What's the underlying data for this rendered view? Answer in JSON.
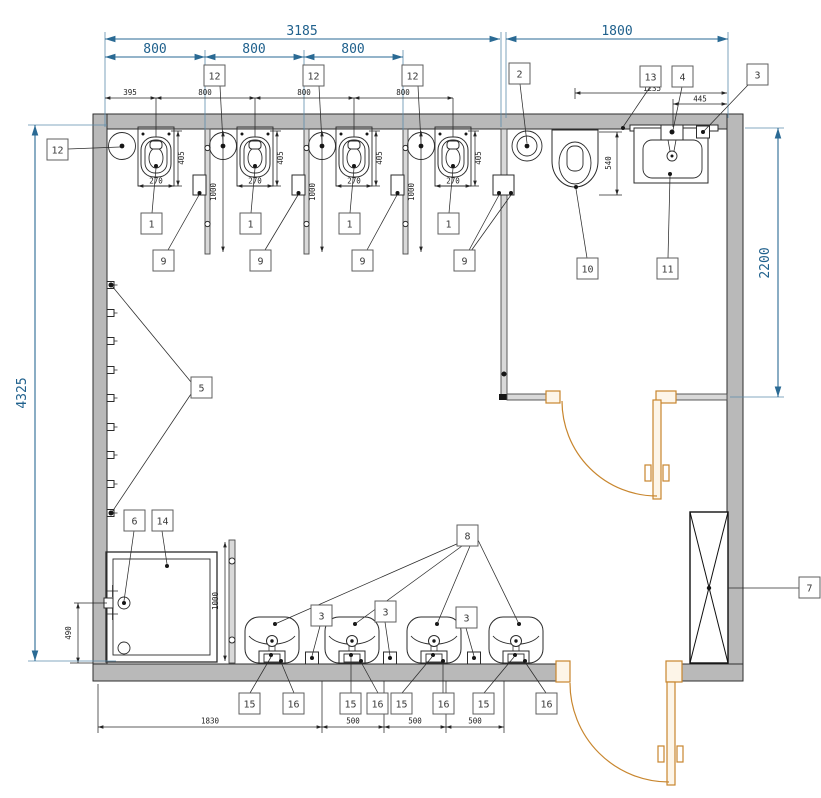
{
  "dims": {
    "overall_width_left": "3185",
    "overall_width_right": "1800",
    "urinal_bay": "800",
    "first_urinal_offset": "395",
    "overall_depth": "4325",
    "wc_room_depth": "2200",
    "urinal_width": "270",
    "urinal_depth": "405",
    "partition_length": "1000",
    "wc_depth": "540",
    "wc_offset_from_wall": "1235",
    "basin_tap_offset": "445",
    "shower_valve_offset": "490",
    "shower_to_first_basin": "1830",
    "basin_spacing": "500"
  },
  "callouts": {
    "c1": "1",
    "c2": "2",
    "c3": "3",
    "c4": "4",
    "c5": "5",
    "c6": "6",
    "c7": "7",
    "c8": "8",
    "c9": "9",
    "c10": "10",
    "c11": "11",
    "c12": "12",
    "c13": "13",
    "c14": "14",
    "c15": "15",
    "c16": "16"
  }
}
